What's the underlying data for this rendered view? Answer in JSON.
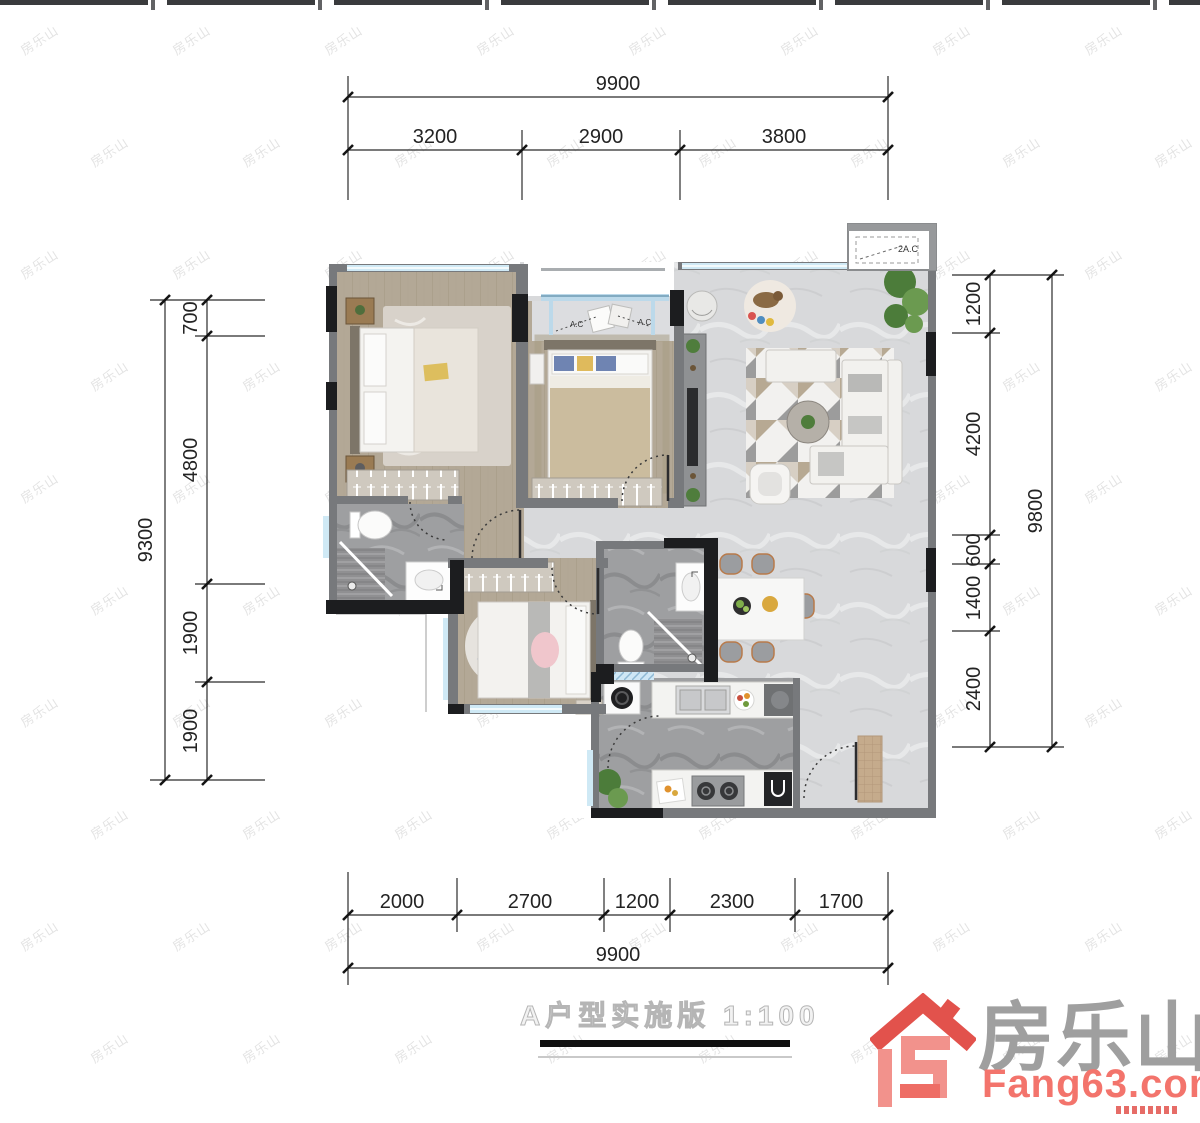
{
  "watermark": {
    "text": "房乐山",
    "cols": 8,
    "rows": 10,
    "x_step": 152,
    "y_step": 112,
    "x_offset": 18,
    "y_offset": 30,
    "x_stagger": 70
  },
  "dimensions": {
    "top": {
      "total": "9900",
      "segments": [
        "3200",
        "2900",
        "3800"
      ]
    },
    "left": {
      "total": "9300",
      "segments": [
        "700",
        "4800",
        "1900",
        "1900"
      ]
    },
    "right": {
      "total": "9800",
      "segments": [
        "1200",
        "4200",
        "600",
        "1400",
        "2400"
      ]
    },
    "bottom": {
      "total": "9900",
      "segments": [
        "2000",
        "2700",
        "1200",
        "2300",
        "1700"
      ]
    }
  },
  "plan": {
    "ac_platform_label": "2A.C",
    "ac_unit_left_label": "A.C",
    "ac_unit_right_label": "A.C"
  },
  "title": {
    "text": "A户型实施版 1:100"
  },
  "logo": {
    "brand": "房乐山",
    "site": "Fang63.com"
  },
  "colors": {
    "wall_gray": "#77797c",
    "wall_black": "#1c1d1f",
    "window_blue": "#cfe9f5",
    "wood_floor": "#b3a896",
    "marble_light": "#d8d9db",
    "marble_dark": "#9e9fa1",
    "logo_red": "#e2524c",
    "logo_pink": "#f2928c",
    "logo_gray": "#9f9f9f",
    "site_red": "#f3746c"
  }
}
